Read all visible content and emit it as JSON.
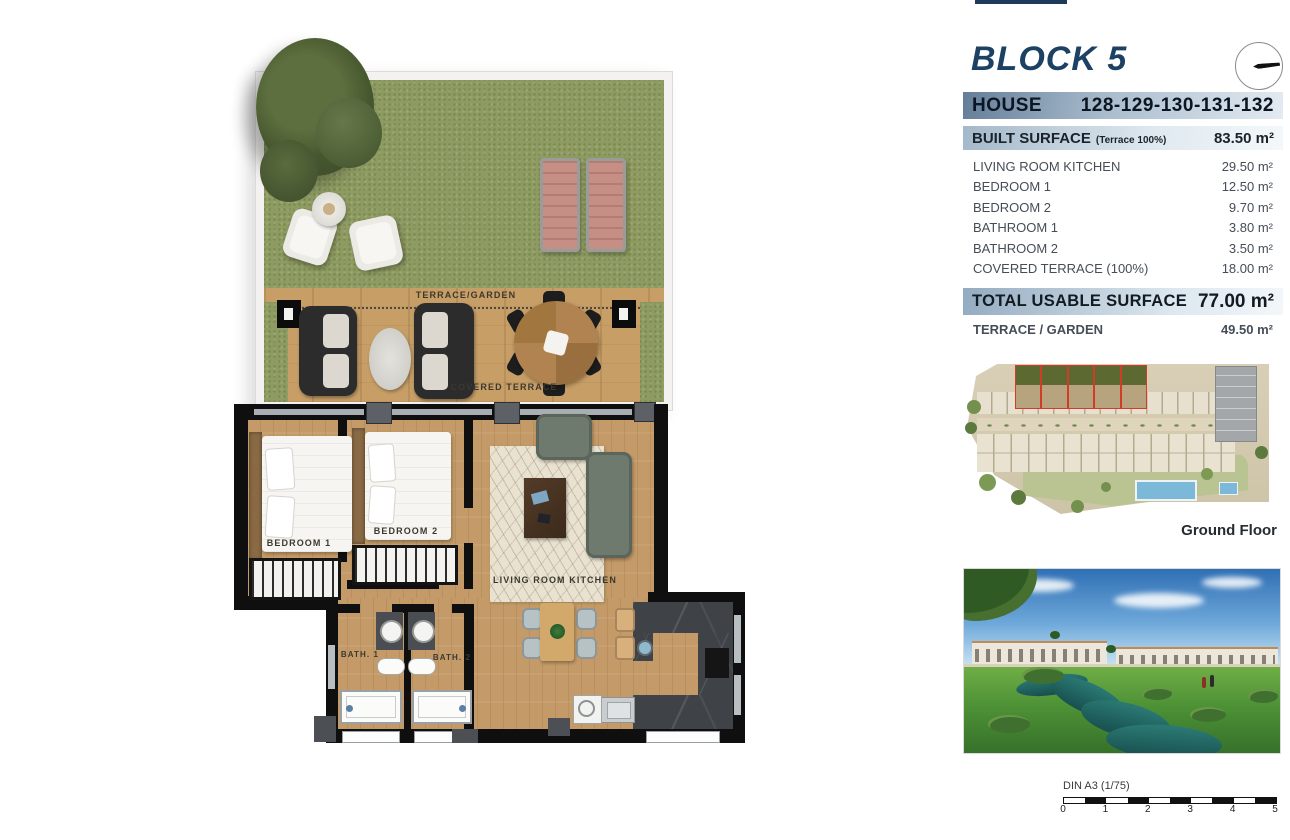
{
  "header": {
    "block_title": "BLOCK 5"
  },
  "house": {
    "label": "HOUSE",
    "numbers": "128-129-130-131-132"
  },
  "built_surface": {
    "label": "BUILT SURFACE",
    "note": "(Terrace 100%)",
    "value": "83.50 m²"
  },
  "rooms": [
    {
      "label": "LIVING ROOM KITCHEN",
      "value": "29.50 m²"
    },
    {
      "label": "BEDROOM 1",
      "value": "12.50 m²"
    },
    {
      "label": "BEDROOM 2",
      "value": "9.70 m²"
    },
    {
      "label": "BATHROOM 1",
      "value": "3.80 m²"
    },
    {
      "label": "BATHROOM 2",
      "value": "3.50 m²"
    },
    {
      "label": "COVERED TERRACE (100%)",
      "value": "18.00 m²"
    }
  ],
  "total": {
    "label": "TOTAL USABLE SURFACE",
    "value": "77.00 m²"
  },
  "terrace_garden": {
    "label": "TERRACE / GARDEN",
    "value": "49.50 m²"
  },
  "siteplan": {
    "caption": "Ground Floor"
  },
  "scale": {
    "note": "DIN A3 (1/75)",
    "ticks": [
      "0",
      "1",
      "2",
      "3",
      "4",
      "5"
    ]
  },
  "plan_labels": {
    "terrace_garden": "TERRACE/GARDEN",
    "covered_terrace": "COVERED TERRACE",
    "bedroom1": "BEDROOM 1",
    "bedroom2": "BEDROOM 2",
    "living": "LIVING ROOM KITCHEN",
    "bath1": "BATH. 1",
    "bath2": "BATH. 2"
  },
  "colors": {
    "accent_navy": "#1c4163",
    "bar_house_start": "#647e99",
    "bar_light_start": "#a3b8c9",
    "highlight_red": "#d03c28",
    "grass": "#8e9c62",
    "deck_wood": "#c79e66",
    "floor_wood": "#c49b68",
    "wall": "#0f0f0f"
  }
}
